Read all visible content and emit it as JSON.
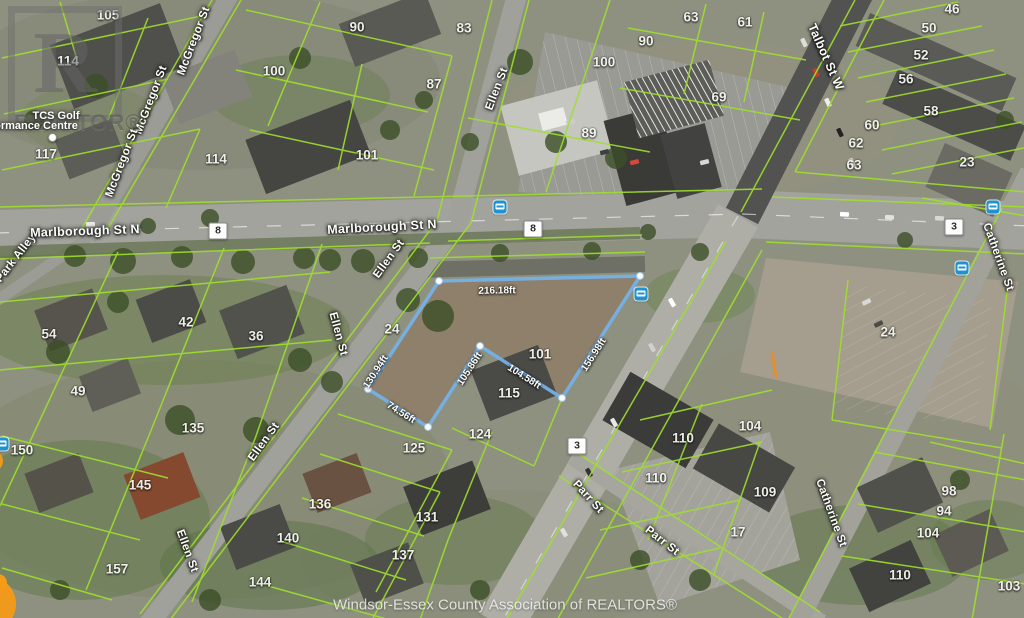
{
  "map": {
    "attribution": "Windsor-Essex County Association of REALTORS®",
    "watermark": {
      "logo_letter": "R",
      "word": "REALTOR®"
    },
    "poi": {
      "line1": "TCS Golf",
      "line2": "ormance Centre"
    },
    "colors": {
      "parcel_line": "#9fdf2d",
      "highlight_stroke": "#74b2e8",
      "bus_icon": "#1e93cf",
      "orange_marker": "#f59b17",
      "badge_text": "#2b2b2b"
    },
    "route_badges": [
      {
        "label": "8",
        "x": 218,
        "y": 231
      },
      {
        "label": "8",
        "x": 533,
        "y": 229
      },
      {
        "label": "3",
        "x": 954,
        "y": 227
      },
      {
        "label": "3",
        "x": 577,
        "y": 446
      }
    ],
    "bus_stops": [
      {
        "x": 500,
        "y": 207
      },
      {
        "x": 641,
        "y": 294
      },
      {
        "x": 993,
        "y": 207
      },
      {
        "x": 962,
        "y": 268
      },
      {
        "x": 2,
        "y": 444
      }
    ],
    "street_labels": [
      {
        "text": "McGregor St",
        "x": 194,
        "y": 41,
        "rot": -69
      },
      {
        "text": "McGregor St",
        "x": 151,
        "y": 100,
        "rot": -69
      },
      {
        "text": "McGregor St",
        "x": 122,
        "y": 163,
        "rot": -69
      },
      {
        "text": "Park Alley",
        "x": 16,
        "y": 258,
        "rot": -52
      },
      {
        "text": "Marlborough St N",
        "x": 85,
        "y": 231,
        "rot": -2,
        "big": true
      },
      {
        "text": "Marlborough St N",
        "x": 382,
        "y": 227,
        "rot": -3,
        "big": true
      },
      {
        "text": "Ellen St",
        "x": 497,
        "y": 89,
        "rot": -69
      },
      {
        "text": "Ellen St",
        "x": 389,
        "y": 259,
        "rot": -54
      },
      {
        "text": "Ellen St",
        "x": 338,
        "y": 334,
        "rot": 75
      },
      {
        "text": "Ellen St",
        "x": 264,
        "y": 442,
        "rot": -54
      },
      {
        "text": "Ellen St",
        "x": 187,
        "y": 551,
        "rot": 70
      },
      {
        "text": "Talbot St W",
        "x": 826,
        "y": 57,
        "rot": 66,
        "big": true
      },
      {
        "text": "Parr St",
        "x": 588,
        "y": 497,
        "rot": 48
      },
      {
        "text": "Parr St",
        "x": 662,
        "y": 541,
        "rot": 38
      },
      {
        "text": "Catherine St",
        "x": 998,
        "y": 257,
        "rot": 70
      },
      {
        "text": "Catherine St",
        "x": 831,
        "y": 513,
        "rot": 70
      }
    ],
    "parcel_labels": [
      {
        "text": "105",
        "x": 108,
        "y": 15
      },
      {
        "text": "114",
        "x": 68,
        "y": 61
      },
      {
        "text": "117",
        "x": 46,
        "y": 154
      },
      {
        "text": "100",
        "x": 274,
        "y": 71
      },
      {
        "text": "90",
        "x": 357,
        "y": 27
      },
      {
        "text": "83",
        "x": 464,
        "y": 28
      },
      {
        "text": "87",
        "x": 434,
        "y": 84
      },
      {
        "text": "114",
        "x": 216,
        "y": 159
      },
      {
        "text": "101",
        "x": 367,
        "y": 155
      },
      {
        "text": "63",
        "x": 691,
        "y": 17
      },
      {
        "text": "61",
        "x": 745,
        "y": 22
      },
      {
        "text": "90",
        "x": 646,
        "y": 41
      },
      {
        "text": "100",
        "x": 604,
        "y": 62
      },
      {
        "text": "69",
        "x": 719,
        "y": 97
      },
      {
        "text": "89",
        "x": 589,
        "y": 133
      },
      {
        "text": "46",
        "x": 952,
        "y": 9
      },
      {
        "text": "50",
        "x": 929,
        "y": 28
      },
      {
        "text": "52",
        "x": 921,
        "y": 55
      },
      {
        "text": "56",
        "x": 906,
        "y": 79
      },
      {
        "text": "58",
        "x": 931,
        "y": 111
      },
      {
        "text": "60",
        "x": 872,
        "y": 125
      },
      {
        "text": "62",
        "x": 856,
        "y": 143
      },
      {
        "text": "63",
        "x": 854,
        "y": 165
      },
      {
        "text": "23",
        "x": 967,
        "y": 162
      },
      {
        "text": "54",
        "x": 49,
        "y": 334
      },
      {
        "text": "42",
        "x": 186,
        "y": 322
      },
      {
        "text": "36",
        "x": 256,
        "y": 336
      },
      {
        "text": "49",
        "x": 78,
        "y": 391
      },
      {
        "text": "24",
        "x": 392,
        "y": 329
      },
      {
        "text": "101",
        "x": 540,
        "y": 354
      },
      {
        "text": "115",
        "x": 509,
        "y": 393
      },
      {
        "text": "24",
        "x": 888,
        "y": 332
      },
      {
        "text": "135",
        "x": 193,
        "y": 428
      },
      {
        "text": "125",
        "x": 414,
        "y": 448
      },
      {
        "text": "124",
        "x": 480,
        "y": 434
      },
      {
        "text": "150",
        "x": 22,
        "y": 450
      },
      {
        "text": "145",
        "x": 140,
        "y": 485
      },
      {
        "text": "136",
        "x": 320,
        "y": 504
      },
      {
        "text": "131",
        "x": 427,
        "y": 517
      },
      {
        "text": "140",
        "x": 288,
        "y": 538
      },
      {
        "text": "137",
        "x": 403,
        "y": 555
      },
      {
        "text": "157",
        "x": 117,
        "y": 569
      },
      {
        "text": "144",
        "x": 260,
        "y": 582
      },
      {
        "text": "110",
        "x": 683,
        "y": 438
      },
      {
        "text": "104",
        "x": 750,
        "y": 426
      },
      {
        "text": "110",
        "x": 656,
        "y": 478
      },
      {
        "text": "109",
        "x": 765,
        "y": 492
      },
      {
        "text": "17",
        "x": 738,
        "y": 532
      },
      {
        "text": "98",
        "x": 949,
        "y": 491
      },
      {
        "text": "94",
        "x": 944,
        "y": 511
      },
      {
        "text": "104",
        "x": 928,
        "y": 533
      },
      {
        "text": "110",
        "x": 900,
        "y": 575
      },
      {
        "text": "103",
        "x": 1009,
        "y": 586
      }
    ],
    "highlight": {
      "polygon": [
        [
          439,
          281
        ],
        [
          640,
          276
        ],
        [
          562,
          398
        ],
        [
          480,
          346
        ],
        [
          428,
          427
        ],
        [
          368,
          389
        ]
      ],
      "dimensions": [
        {
          "text": "216.18ft",
          "x": 497,
          "y": 291,
          "rot": -1
        },
        {
          "text": "156.98ft",
          "x": 594,
          "y": 355,
          "rot": -57
        },
        {
          "text": "104.58ft",
          "x": 524,
          "y": 377,
          "rot": 32
        },
        {
          "text": "105.86ft",
          "x": 470,
          "y": 369,
          "rot": -57
        },
        {
          "text": "74.56ft",
          "x": 401,
          "y": 413,
          "rot": 32
        },
        {
          "text": "130.94ft",
          "x": 376,
          "y": 372,
          "rot": -57
        }
      ]
    }
  }
}
